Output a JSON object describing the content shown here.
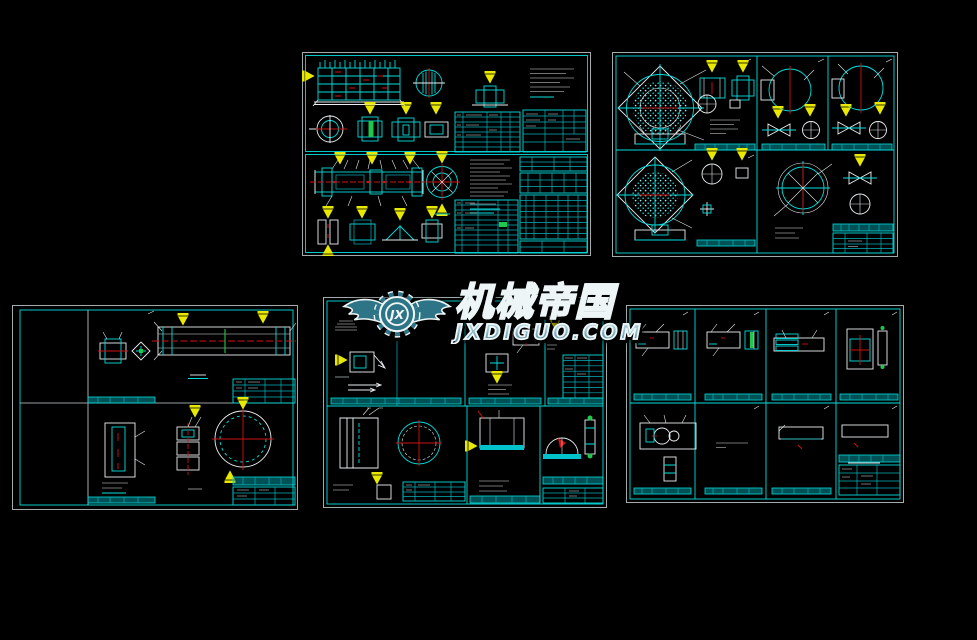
{
  "workspace": {
    "background": "#000000",
    "width": 977,
    "height": 640
  },
  "watermark": {
    "monogram": "JX",
    "brand": "机械帝国",
    "domain": "JXDIGUO.COM",
    "text_fill": "#6fa2b2",
    "text_outline": "#eef5f6",
    "logo_fill": "#2e7487"
  },
  "palette": {
    "canvas_black": "#000000",
    "paper_edge_white": "#c9d6d6",
    "border_cyan": "#00dede",
    "line_white": "#e9eef0",
    "centerline_red": "#d01212",
    "section_arrow_yellow": "#e9e900",
    "accent_green": "#1ec84a"
  },
  "sheets": [
    {
      "id": "sheet-top-left",
      "label": "two stacked assembly sheets with liner grid, shaft assembly, parts tables"
    },
    {
      "id": "sheet-top-right",
      "label": "six detail panels with cross-hatched end covers and trunnions"
    },
    {
      "id": "sheet-bottom-left",
      "label": "cylinder and bolted-flange detail sheet"
    },
    {
      "id": "sheet-bottom-middle",
      "label": "component detail sheet (under watermark)"
    },
    {
      "id": "sheet-bottom-right",
      "label": "eight small-part detail panels"
    }
  ]
}
